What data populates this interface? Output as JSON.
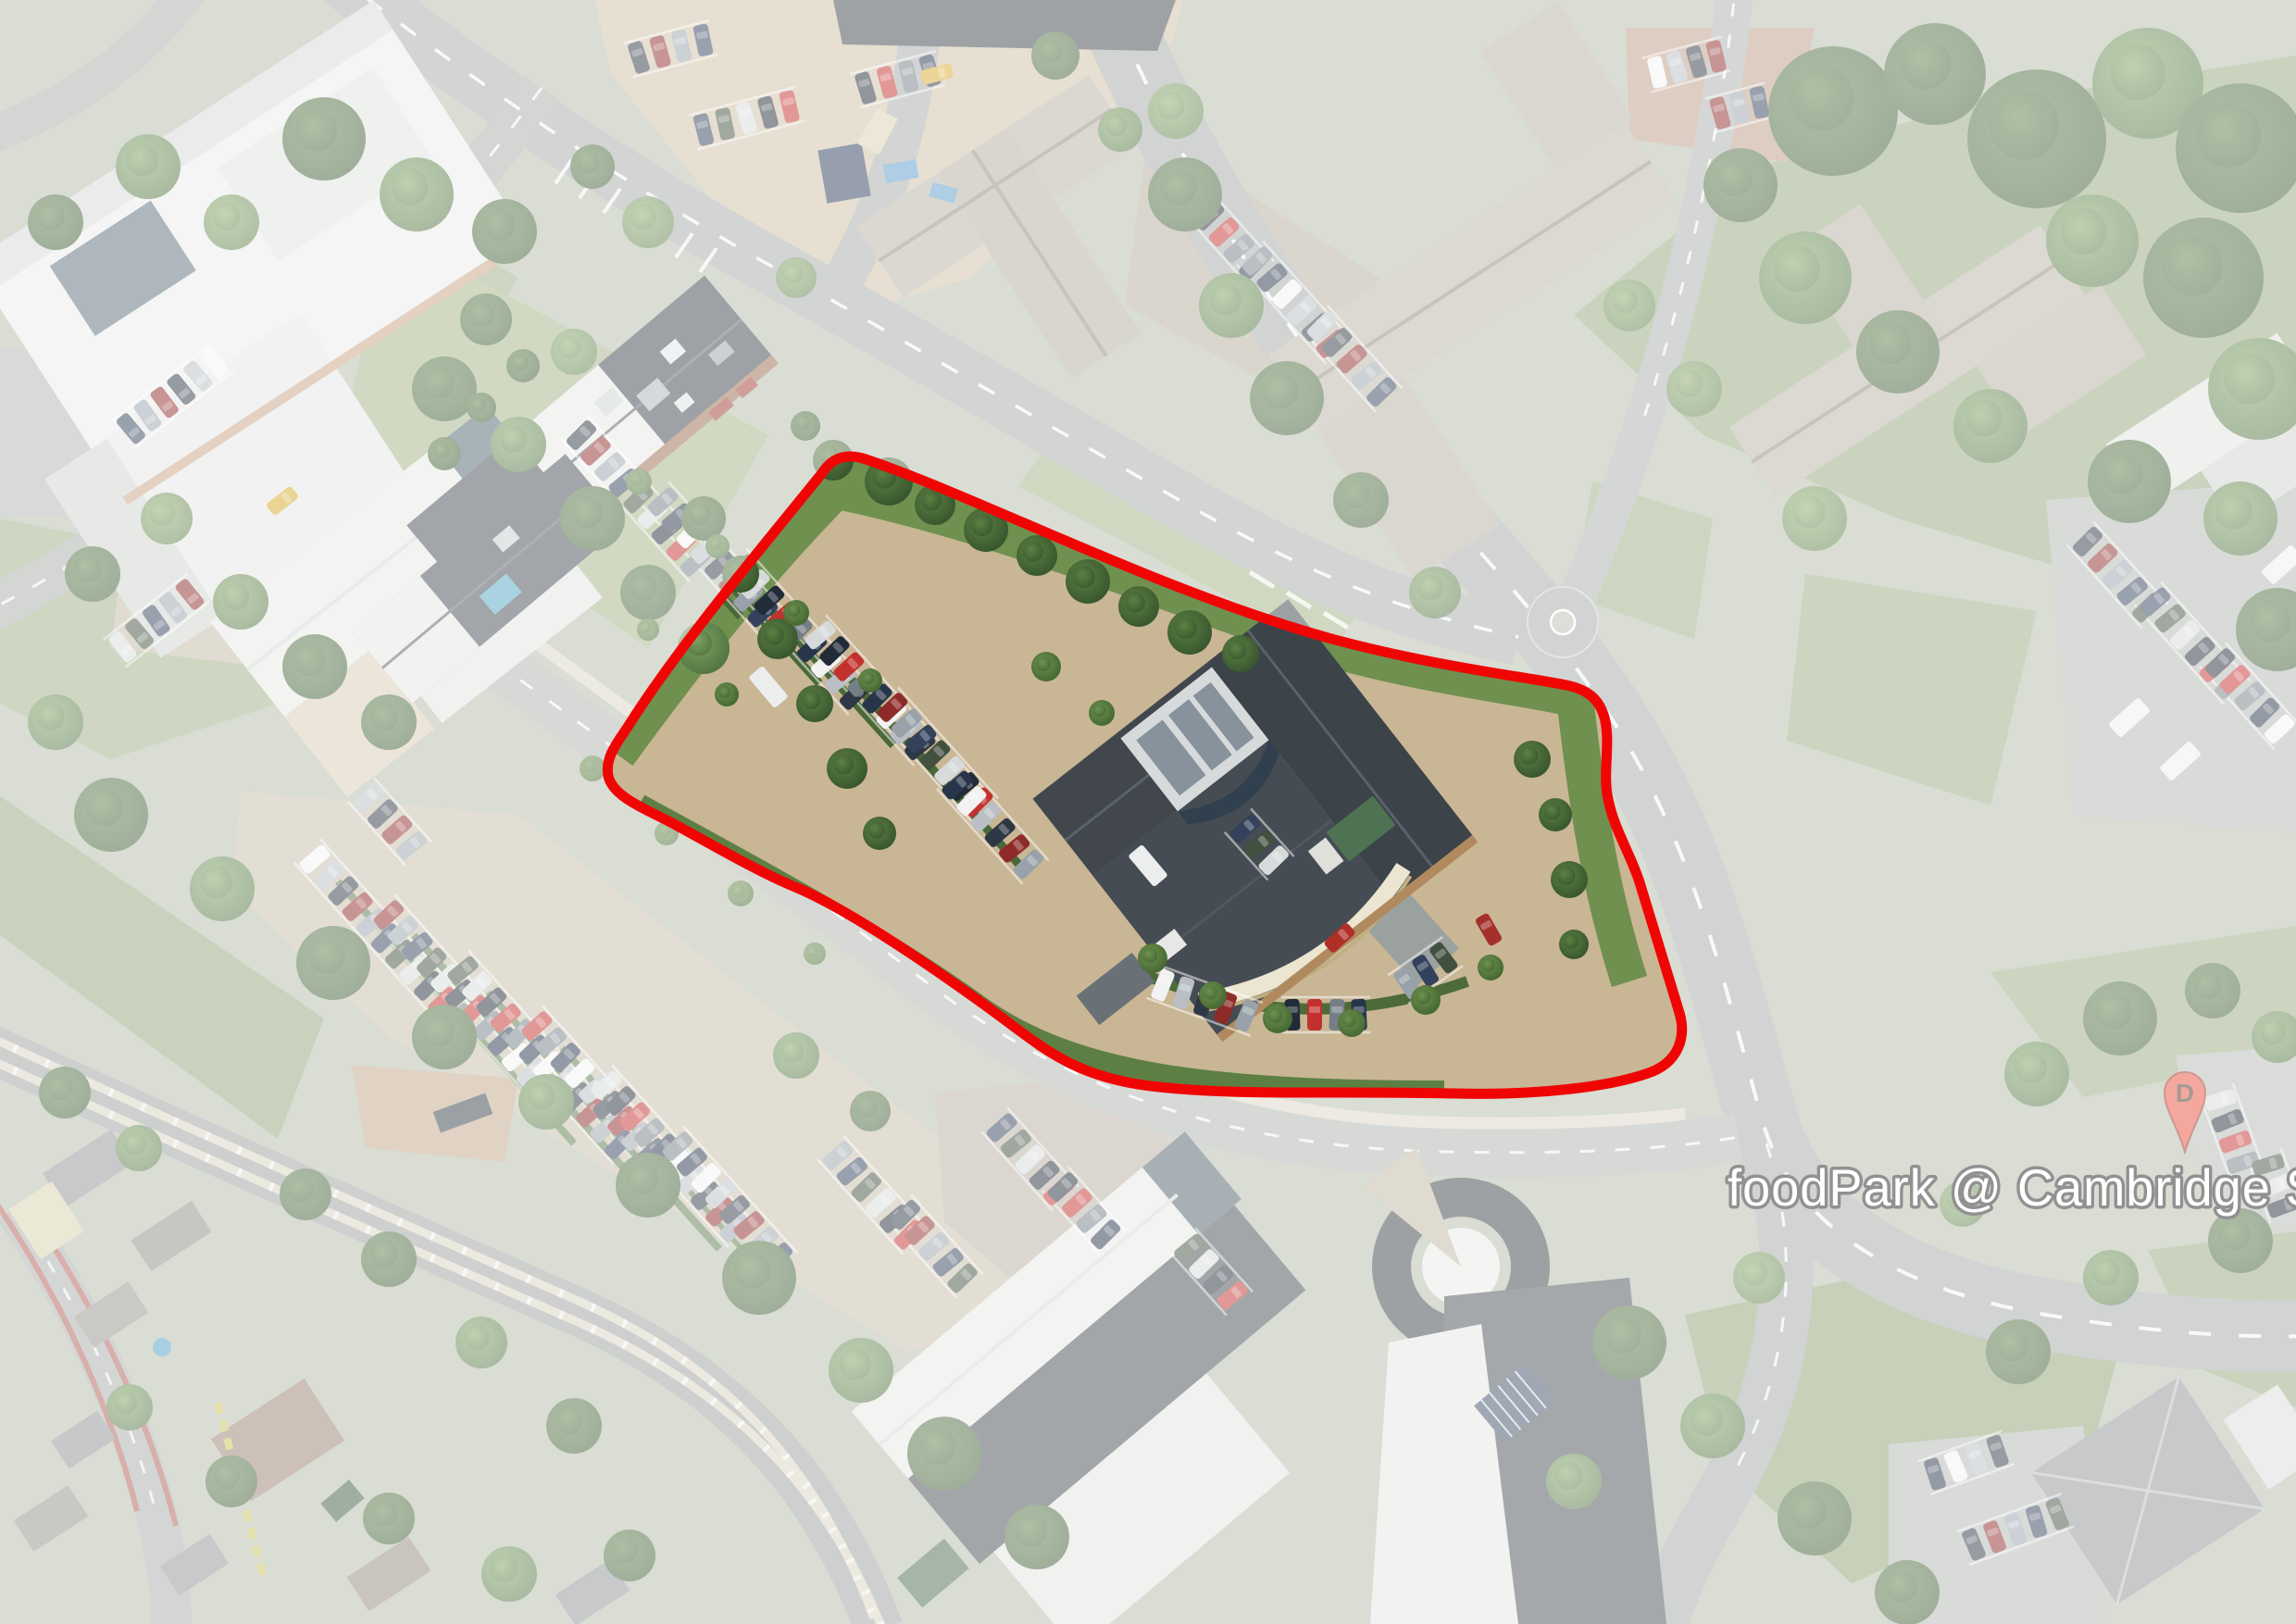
{
  "map": {
    "overlay": {
      "label": "foodPark @ Cambridge S",
      "label_color": "#ffffff",
      "label_halo": "#222222",
      "marker_letter": "D",
      "marker_color": "#e9503a",
      "boundary_color": "#f00505"
    }
  }
}
